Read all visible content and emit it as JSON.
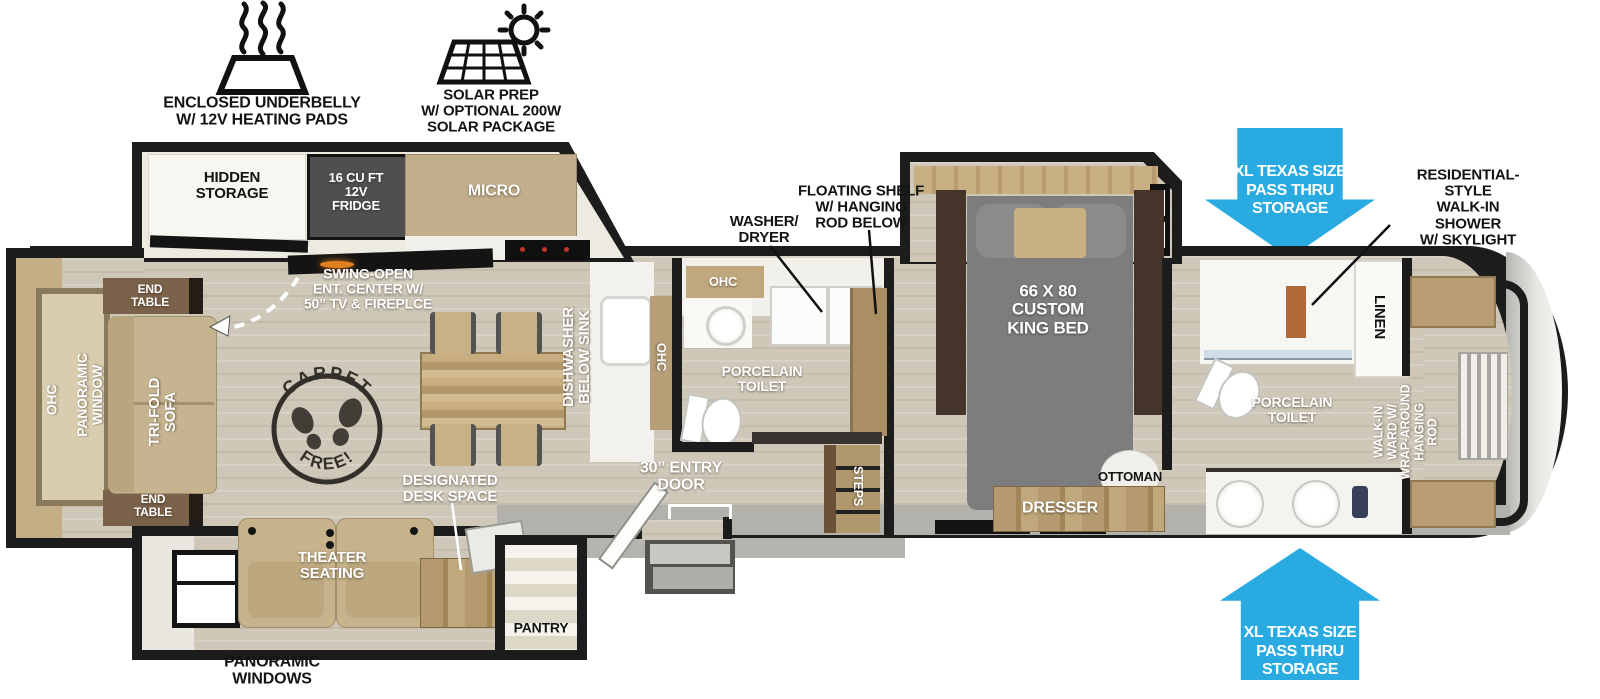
{
  "colors": {
    "arrow_blue": "#29abe2",
    "wall_black": "#1c1c1c",
    "floor_wood": "#cfc8b9",
    "cabinet_tan": "#c2ae8c",
    "bed_gray": "#7d7d7d",
    "exterior_gray": "#b3b1ac"
  },
  "top_callouts": {
    "underbelly": {
      "icon": "heating-pad-icon",
      "label": "ENCLOSED UNDERBELLY\nW/ 12V HEATING PADS"
    },
    "solar": {
      "icon": "solar-panel-icon",
      "label": "SOLAR PREP\nW/ OPTIONAL 200W\nSOLAR PACKAGE"
    }
  },
  "exterior_callouts": {
    "pass_thru_top": "XL TEXAS SIZE\nPASS THRU\nSTORAGE",
    "pass_thru_bottom": "XL TEXAS SIZE\nPASS THRU\nSTORAGE",
    "shower_note": "RESIDENTIAL-STYLE\nWALK-IN SHOWER\nW/ SKYLIGHT",
    "panoramic_windows": "PANORAMIC\nWINDOWS",
    "washer_dryer": "WASHER/\nDRYER",
    "floating_shelf": "FLOATING SHELF\nW/ HANGING\nROD BELOW"
  },
  "living_area": {
    "hidden_storage": "HIDDEN\nSTORAGE",
    "fridge": "16 CU FT\n12V\nFRIDGE",
    "micro": "MICRO",
    "swing_ent": "SWING-OPEN\nENT. CENTER W/\n50” TV & FIREPLCE",
    "end_table_top": "END\nTABLE",
    "end_table_bottom": "END\nTABLE",
    "ohc": "OHC",
    "panoramic_window": "PANORAMIC\nWINDOW",
    "tri_fold_sofa": "TRI-FOLD\nSOFA",
    "theater_seating": "THEATER\nSEATING",
    "designated_desk": "DESIGNATED\nDESK SPACE",
    "pantry": "PANTRY",
    "carpet_stamp": {
      "arc_top": "CARPET",
      "arc_bottom": "FREE!"
    }
  },
  "kitchen": {
    "dishwasher": "DISHWASHER\nBELOW SINK",
    "ohc": "OHC"
  },
  "mid_bath": {
    "ohc": "OHC",
    "toilet": "PORCELAIN\nTOILET"
  },
  "entry": {
    "door": "30” ENTRY\nDOOR",
    "steps": "STEPS"
  },
  "bedroom": {
    "bed": "66 X 80\nCUSTOM\nKING BED",
    "ottoman": "OTTOMAN",
    "dresser": "DRESSER"
  },
  "front_bath": {
    "linen": "LINEN",
    "toilet": "PORCELAIN\nTOILET"
  },
  "wardrobe": {
    "walk_in": "WALK-IN\nWARD W/\nWRAP-AROUND\nHANGING\nROD"
  }
}
